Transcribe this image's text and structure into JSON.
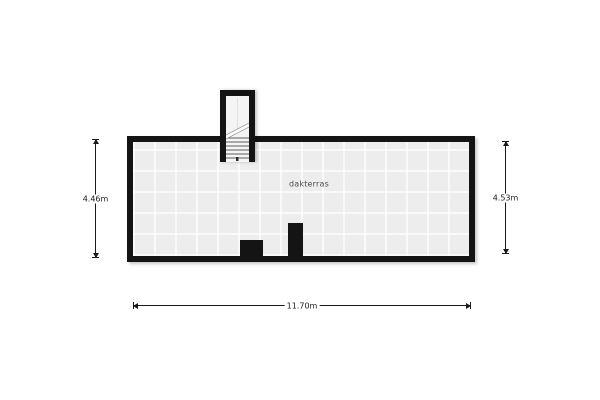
{
  "floorplan": {
    "room_label": "dakterras",
    "dimensions": {
      "left": "4.46m",
      "right": "4.53m",
      "bottom": "11.70m"
    },
    "colors": {
      "wall": "#141414",
      "floor_tile": "#ededed",
      "tile_grout": "#f7f7f7",
      "dimension_line": "#1a1a1a",
      "room_label_text": "#4d4d4d",
      "background": "#ffffff"
    }
  }
}
